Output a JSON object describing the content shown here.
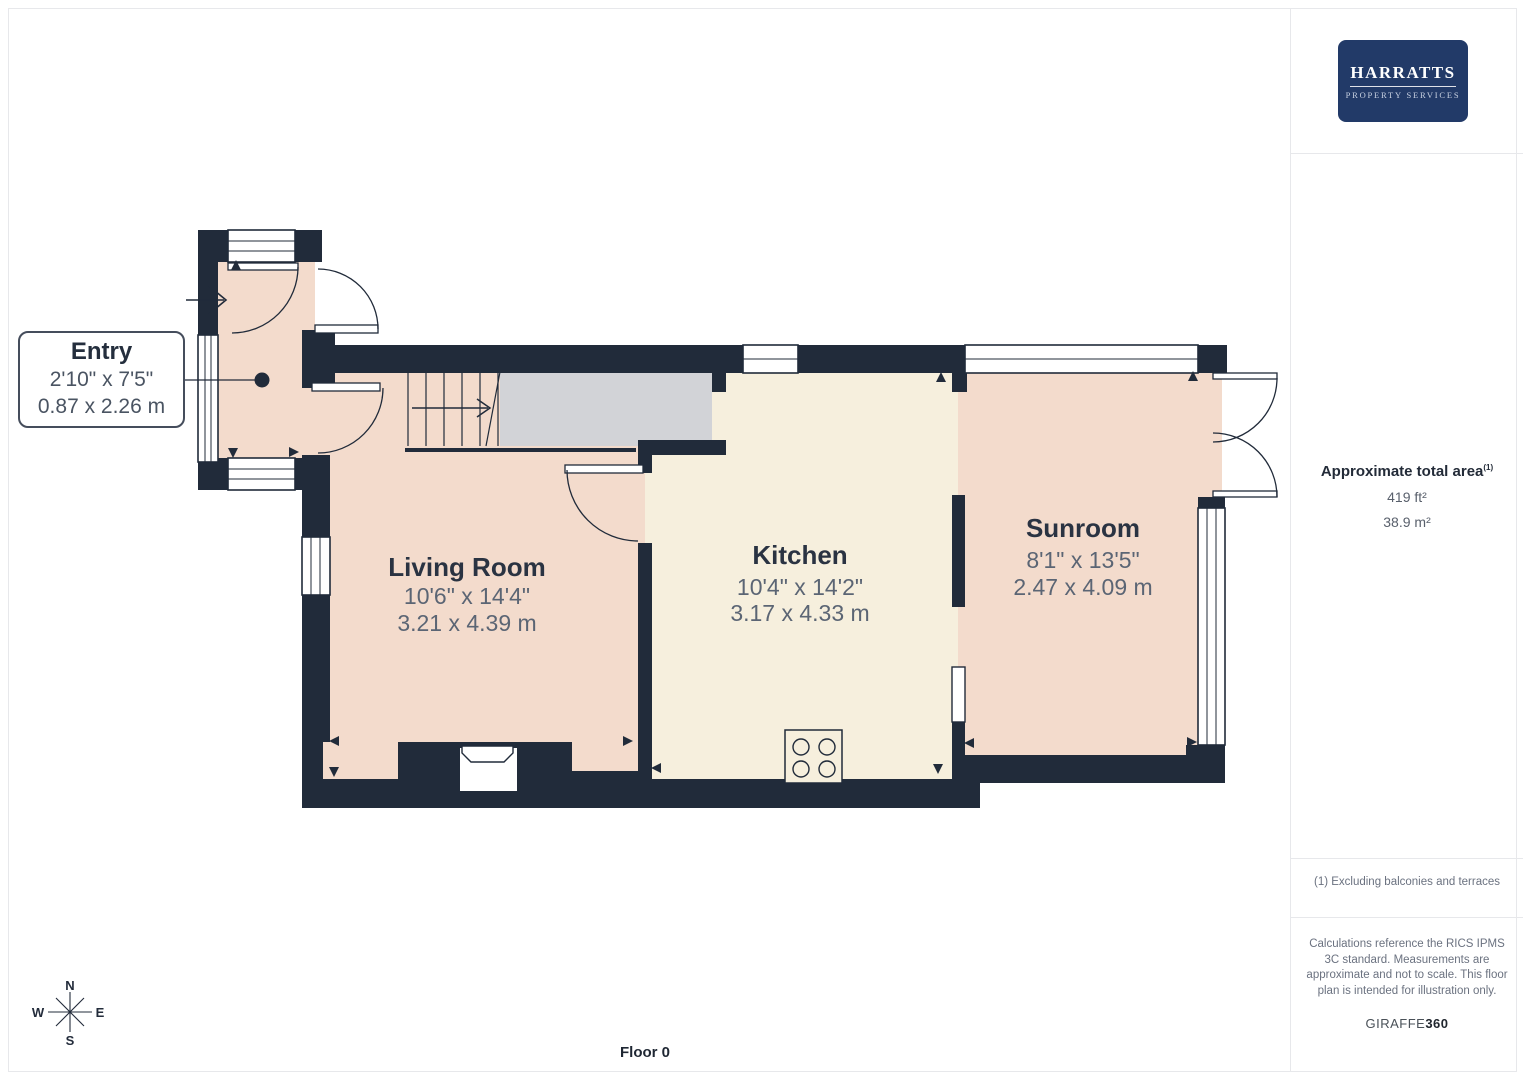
{
  "branding": {
    "logo_line1": "HARRATTS",
    "logo_line2": "PROPERTY SERVICES"
  },
  "sidebar": {
    "area": {
      "heading": "Approximate total area",
      "superscript": "(1)",
      "value_ft": "419 ft²",
      "value_m": "38.9 m²"
    },
    "footnote": "(1) Excluding balconies and terraces",
    "disclaimer": "Calculations reference the RICS IPMS 3C standard. Measurements are approximate and not to scale. This floor plan is intended for illustration only.",
    "brand_giraffe": "GIRAFFE",
    "brand_360": "360"
  },
  "floor": {
    "label": "Floor 0"
  },
  "compass": {
    "n": "N",
    "s": "S",
    "e": "E",
    "w": "W"
  },
  "rooms": [
    {
      "name": "Entry",
      "imperial": "2'10\" x 7'5\"",
      "metric": "0.87 x 2.26 m"
    },
    {
      "name": "Living Room",
      "imperial": "10'6\" x 14'4\"",
      "metric": "3.21 x 4.39 m"
    },
    {
      "name": "Kitchen",
      "imperial": "10'4\" x 14'2\"",
      "metric": "3.17 x 4.33 m"
    },
    {
      "name": "Sunroom",
      "imperial": "8'1\" x 13'5\"",
      "metric": "2.47 x 4.09 m"
    }
  ],
  "colors": {
    "wall": "#212b3a",
    "room_pink": "#f3dbcc",
    "kitchen_cream": "#f6efdd",
    "stair_gray": "#d2d3d7",
    "logo_navy": "#223a68",
    "text_navy": "#2a3342",
    "text_gray": "#5b6574"
  }
}
